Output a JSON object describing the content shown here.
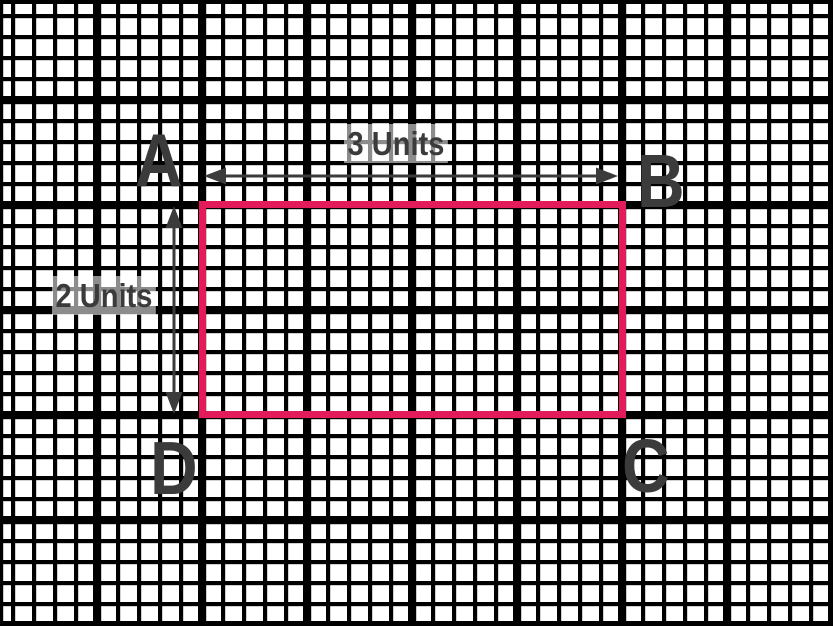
{
  "figure": {
    "description": "Rectangle ABCD drawn on black graph paper with dimension arrows",
    "vertices": [
      {
        "label": "A",
        "position": "top-left"
      },
      {
        "label": "B",
        "position": "top-right"
      },
      {
        "label": "C",
        "position": "bottom-right"
      },
      {
        "label": "D",
        "position": "bottom-left"
      }
    ],
    "dimensions": {
      "horizontal": {
        "label": "3 Units",
        "value": 3,
        "unit": "Units",
        "arrow": "double-headed"
      },
      "vertical": {
        "label": "2 Units",
        "value": 2,
        "unit": "Units",
        "arrow": "double-headed"
      }
    },
    "colors": {
      "rectangle": "#E31B5A",
      "grid_lines": "#000000",
      "text_and_arrows": "#3B3B3B",
      "background": "#FFFFFF"
    }
  }
}
